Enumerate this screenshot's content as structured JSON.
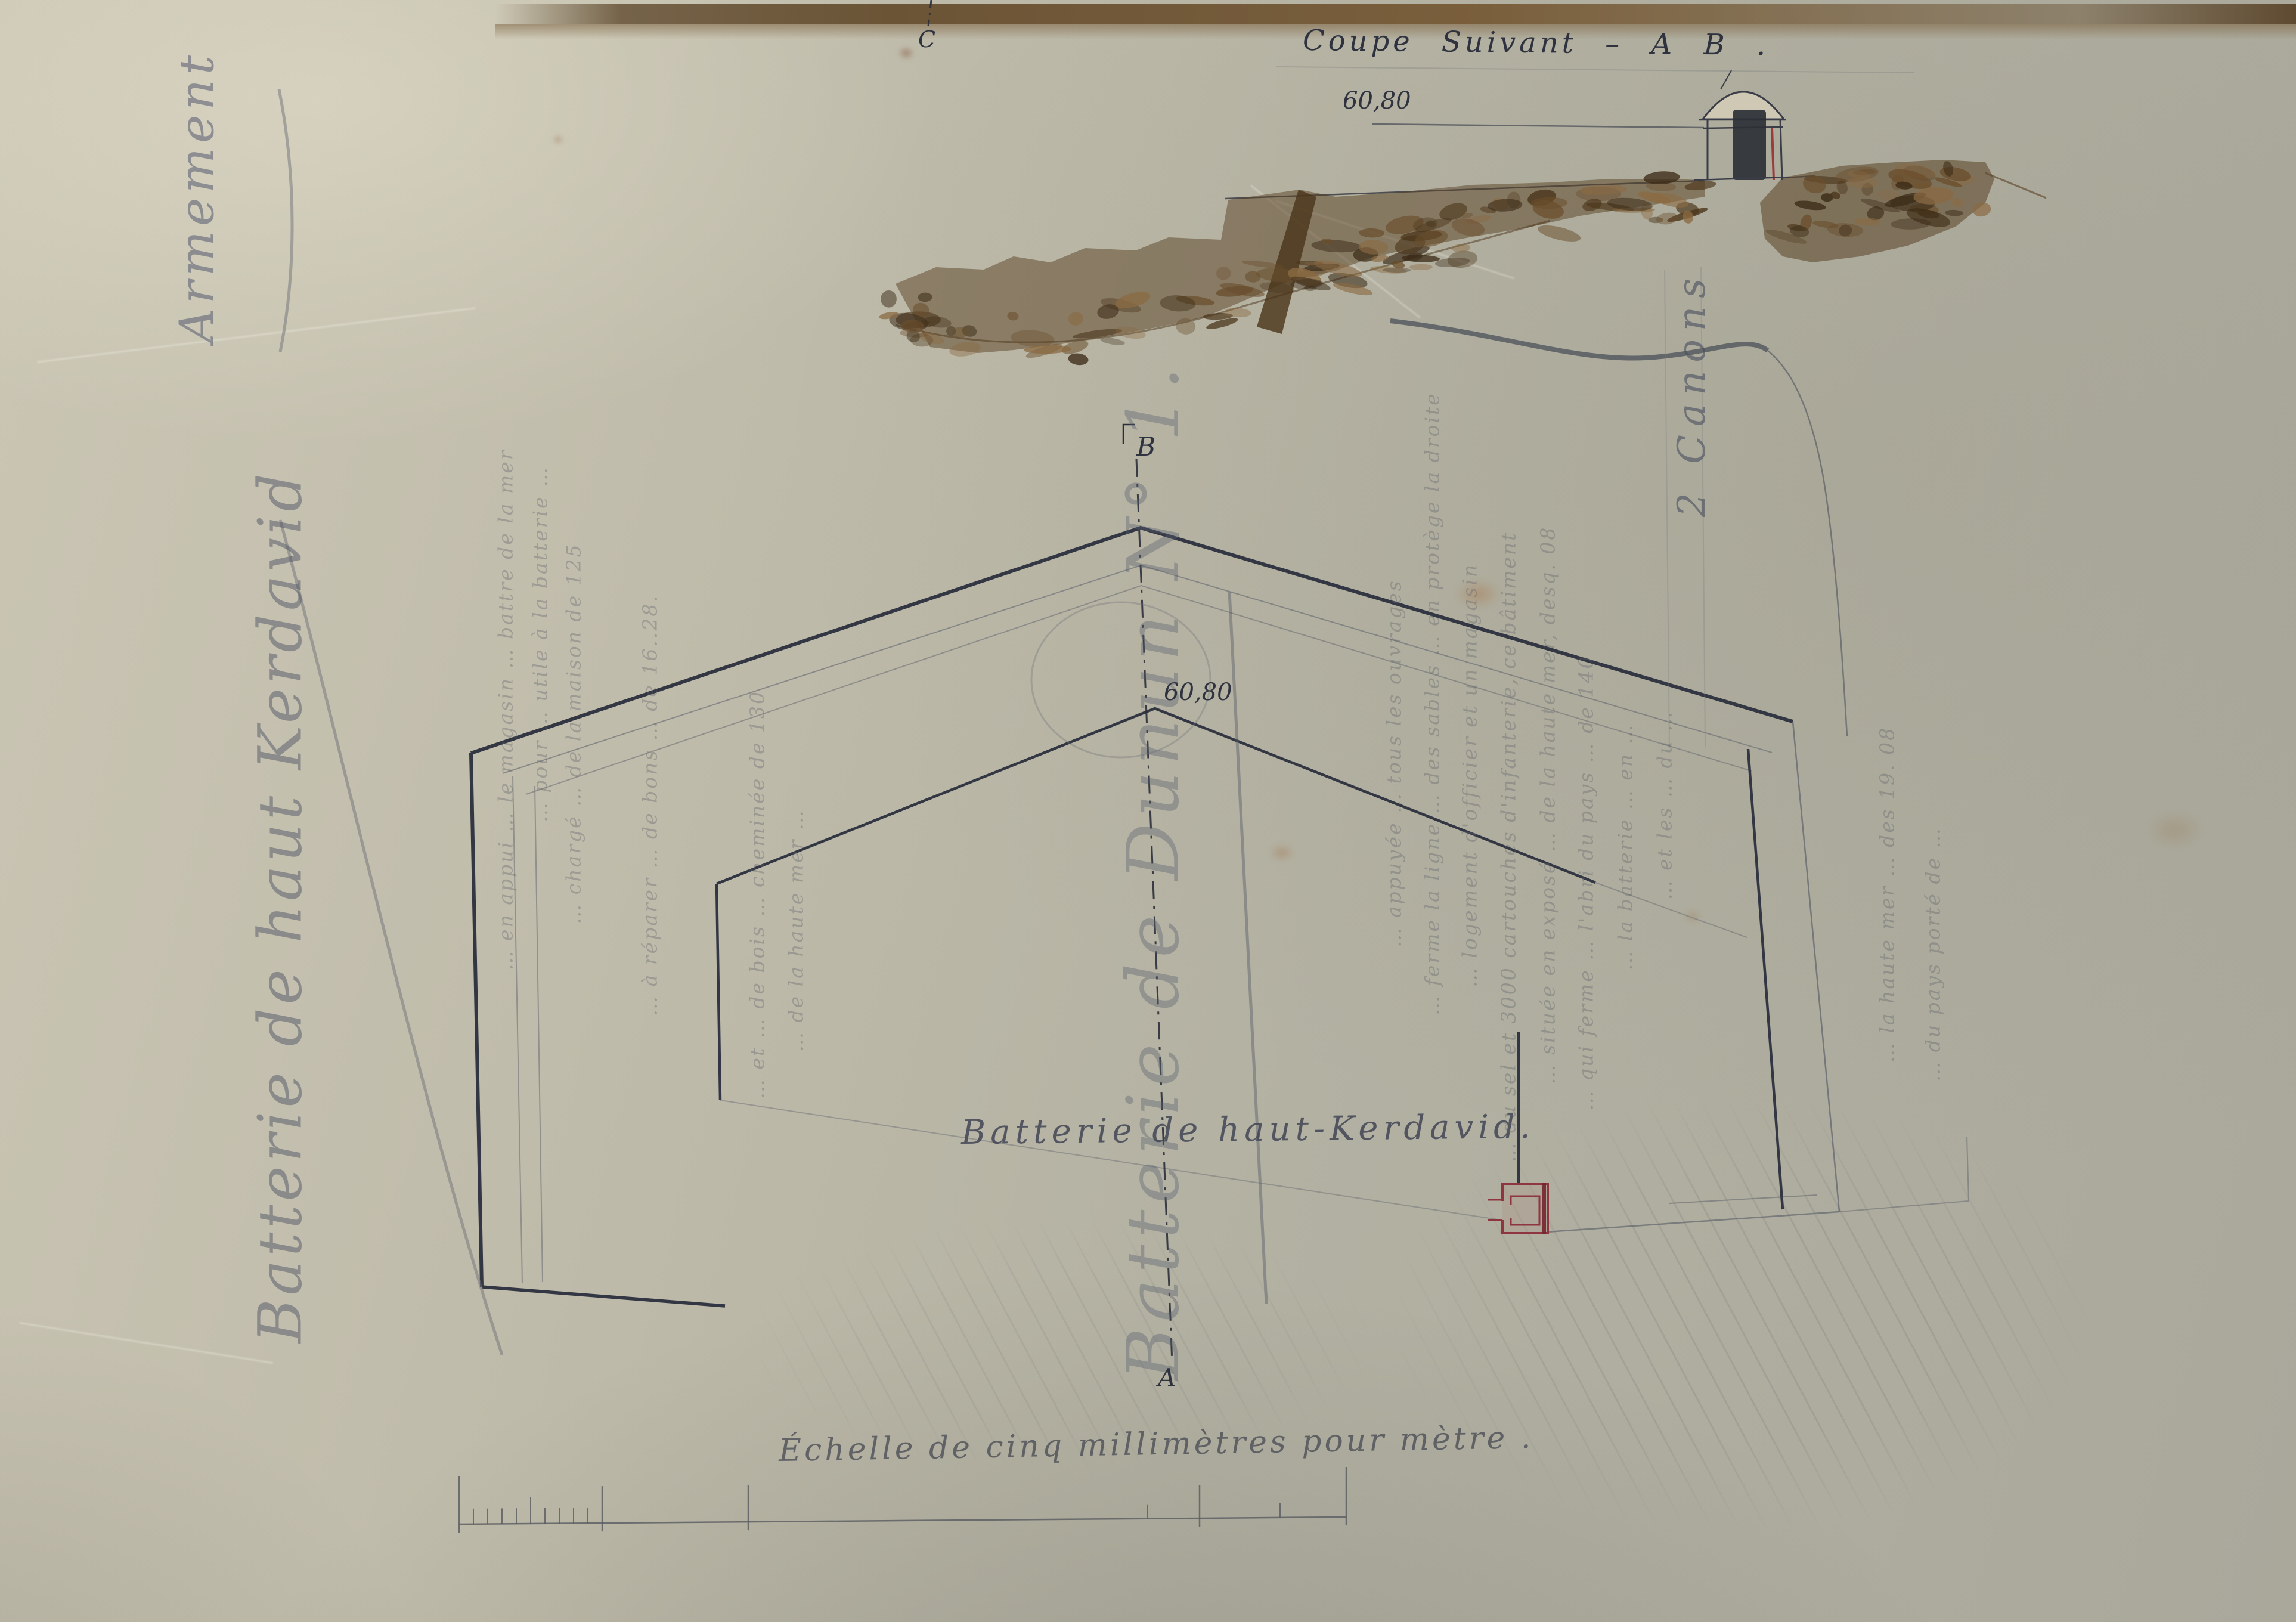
{
  "titles": {
    "armement": "Armement",
    "left_title": "Batterie de haut Kerdavid",
    "coupe_title": "Coupe Suivant – A B .",
    "plan_center_label": "Batterie de haut-Kerdavid.",
    "ghost_title": "Batterie de Dunun N° 1.",
    "armament_note": "2 Canons"
  },
  "labels": {
    "coupe_level": "60,80",
    "plan_level": "60,80",
    "point_a": "A",
    "point_b": "B",
    "point_c": "C"
  },
  "scale": {
    "caption": "Échelle de cinq millimètres pour mètre ."
  },
  "ghost_text": {
    "left_fragments": [
      "… en appui … le magasin … battre de la mer",
      "… pour … utile à la batterie …",
      "… chargé … de la maison de 125",
      "… à réparer … de bons … de 16..28.",
      "… et … de bois … cheminée de 130",
      "… de la haute mer …"
    ],
    "right_fragments": [
      "… appuyée … tous les ouvrages",
      "… ferme la ligne … des sables … en protège la droite",
      "… logement d'officier et un magasin",
      "… du sel et 3000 cartouches d'infanterie, ce bâtiment",
      "… située en exposé … de la haute mer, desq. 08",
      "… qui ferme … l'abri du pays … de 140",
      "… la batterie … en …",
      "… et les … du …",
      "… la haute mer … des 19. 08",
      "… du pays porté de …"
    ]
  },
  "colors": {
    "ink": "#2f3340",
    "pencil": "#6f7277",
    "sepia": "#5a4124",
    "magazine_red": "#8e3540",
    "paper": "#b9b5a6",
    "band_brown": "#6b5436"
  }
}
